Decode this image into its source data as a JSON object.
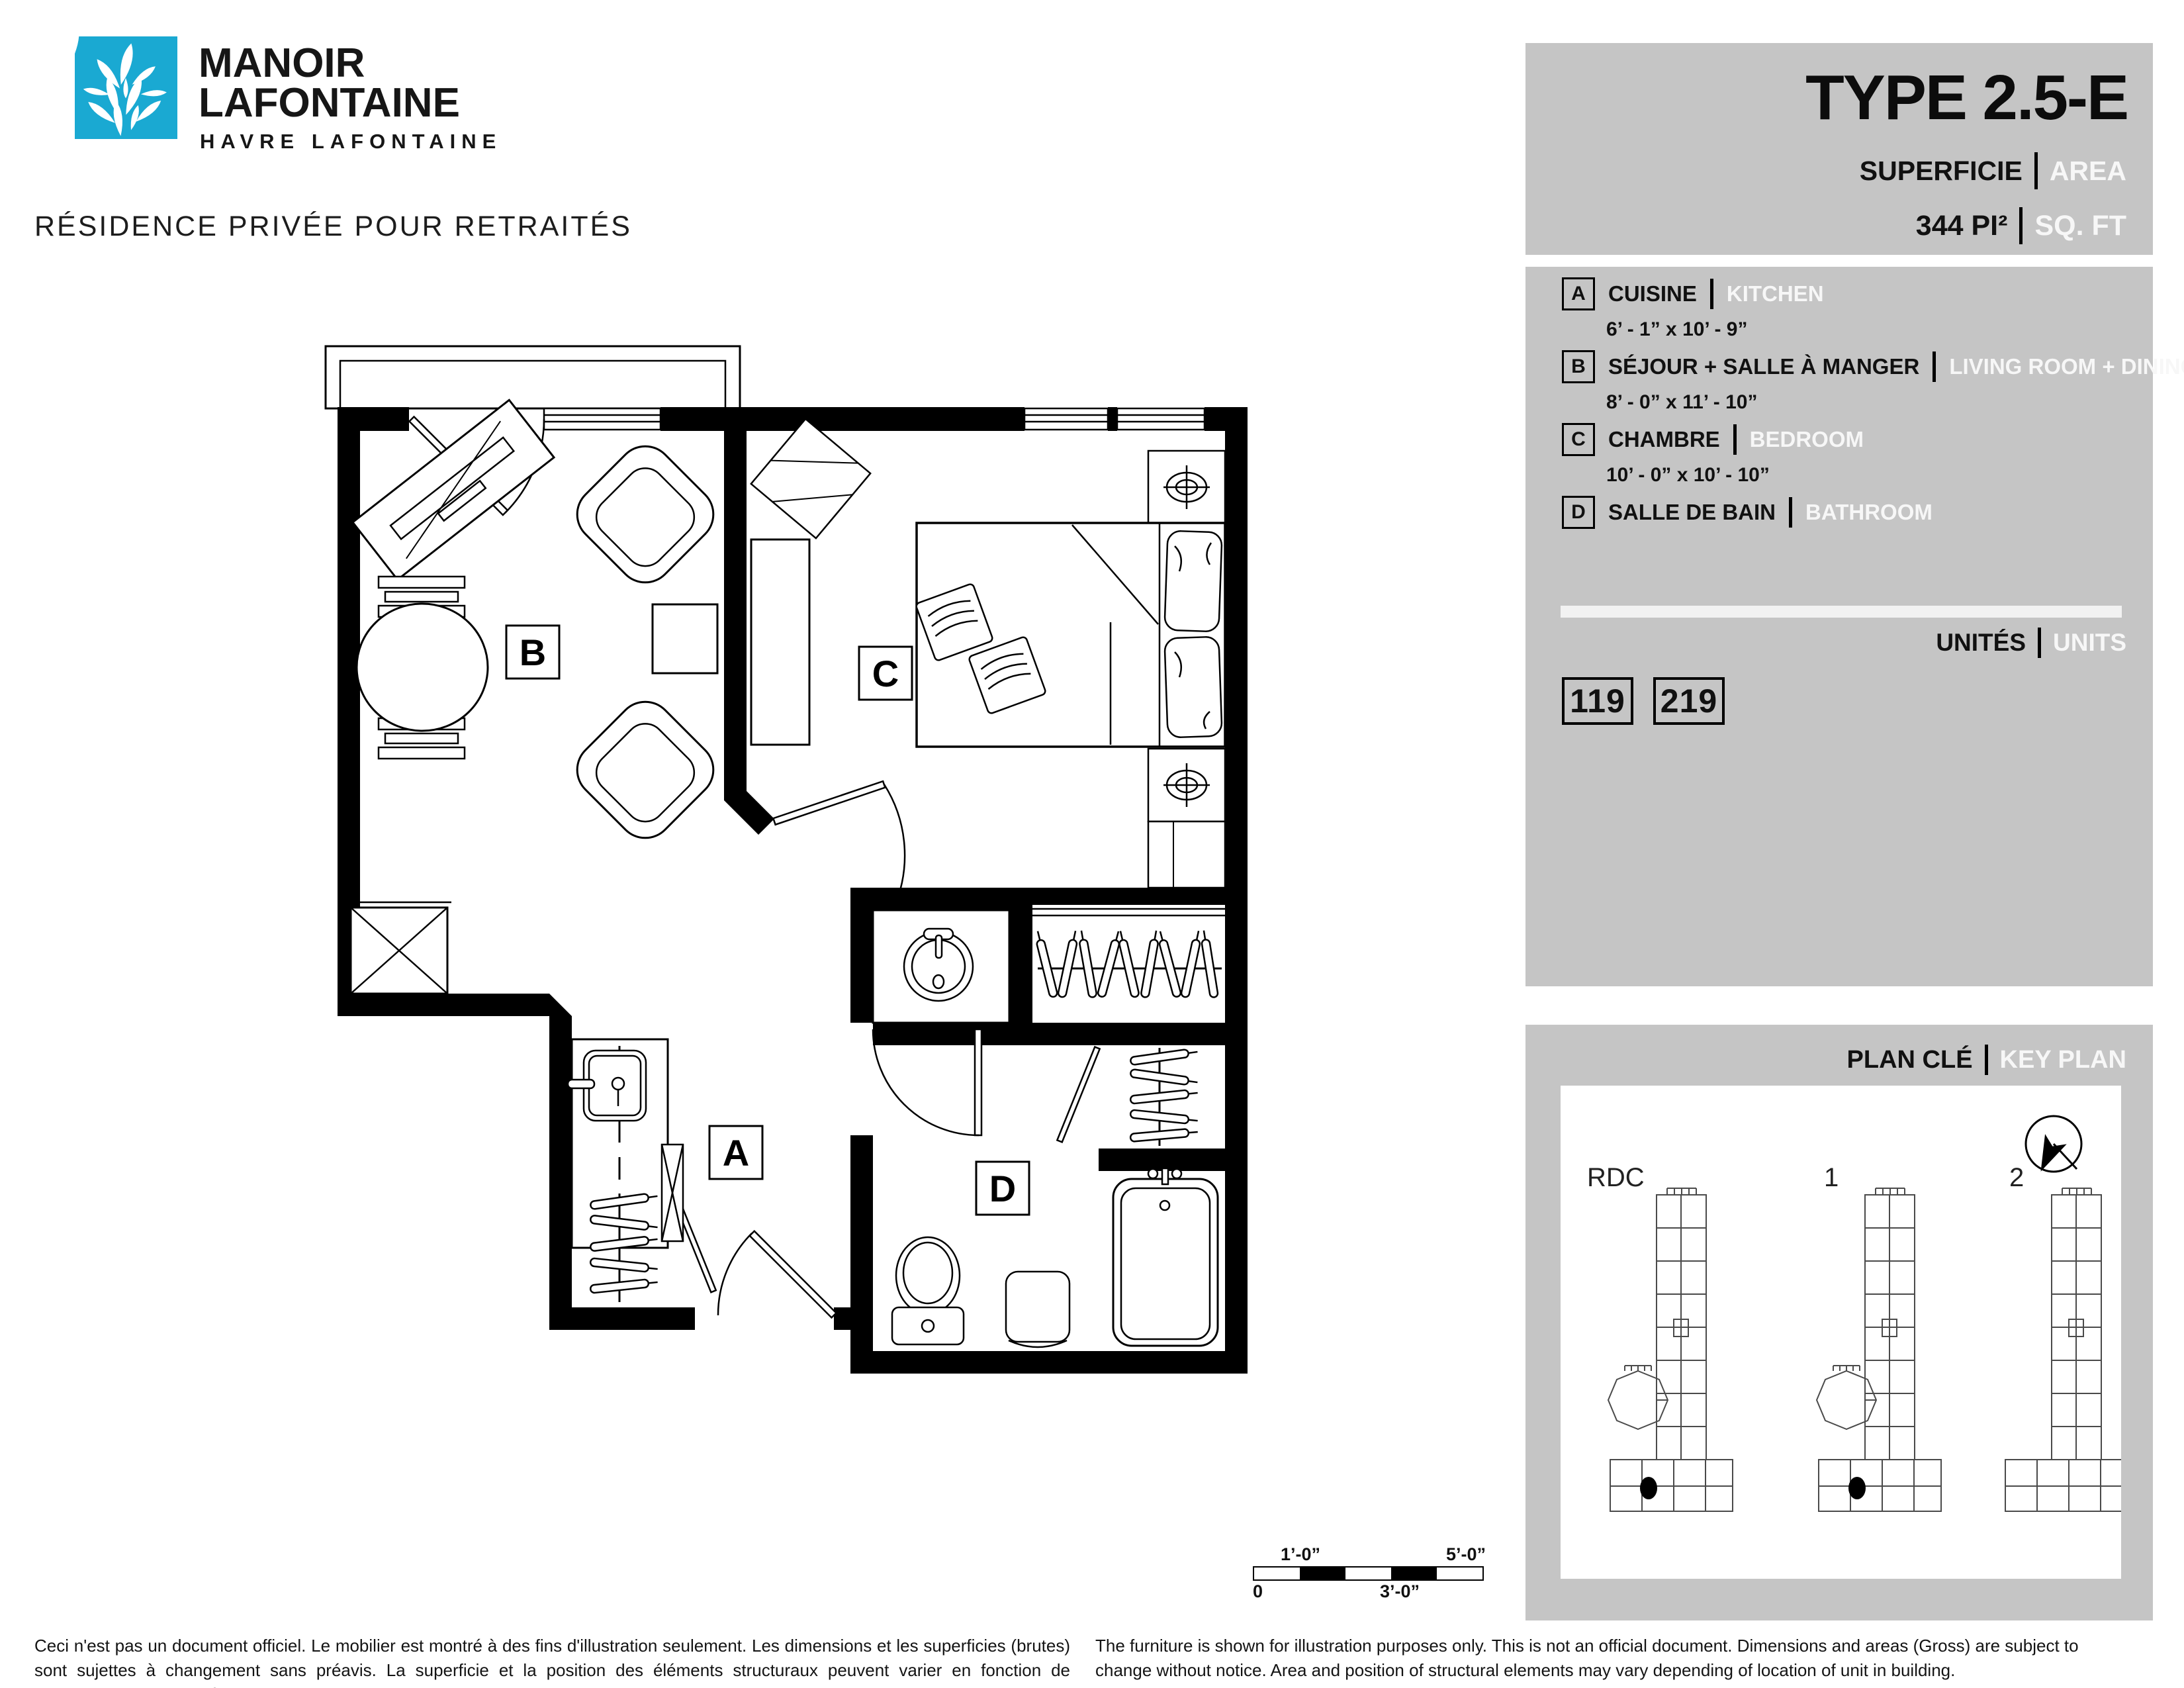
{
  "brand": {
    "logo_color": "#1aa9d2",
    "logo_icon": "leaf-cluster",
    "name_line1": "MANOIR",
    "name_line2": "LAFONTAINE",
    "subtitle": "HAVRE LAFONTAINE",
    "tagline": "RÉSIDENCE PRIVÉE POUR RETRAITÉS"
  },
  "title_panel": {
    "type_label": "TYPE 2.5-E",
    "superficie_fr": "SUPERFICIE",
    "superficie_en": "AREA",
    "area_value": "344  PI²",
    "area_unit_en": "SQ. FT"
  },
  "legend": {
    "items": [
      {
        "key": "A",
        "name_fr": "CUISINE",
        "name_en": "KITCHEN",
        "dimensions": "6’ - 1” x 10’ - 9”"
      },
      {
        "key": "B",
        "name_fr": "SÉJOUR + SALLE À MANGER",
        "name_en": "LIVING ROOM + DINING",
        "dimensions": "8’ - 0” x 11’ - 10”"
      },
      {
        "key": "C",
        "name_fr": "CHAMBRE",
        "name_en": "BEDROOM",
        "dimensions": "10’ -  0” x 10’ - 10”"
      },
      {
        "key": "D",
        "name_fr": "SALLE DE BAIN",
        "name_en": "BATHROOM",
        "dimensions": ""
      }
    ]
  },
  "units": {
    "label_fr": "UNITÉS",
    "label_en": "UNITS",
    "numbers": [
      "119",
      "219"
    ]
  },
  "key_plan": {
    "label_fr": "PLAN CLÉ",
    "label_en": "KEY PLAN",
    "compass_icon": "north-arrow-compass",
    "floors": [
      "RDC",
      "1",
      "2"
    ]
  },
  "floor_plan": {
    "room_labels": {
      "a": "A",
      "b": "B",
      "c": "C",
      "d": "D"
    }
  },
  "scale_bar": {
    "tick_top_left": "1’-0”",
    "tick_top_right": "5’-0”",
    "tick_bottom_left": "0",
    "tick_bottom_mid": "3’-0”"
  },
  "disclaimer_fr": "Ceci n'est pas un document officiel. Le mobilier est montré à des fins d'illustration seulement. Les dimensions et les superficies (brutes) sont sujettes à changement sans préavis. La superficie et la position des éléments structuraux peuvent varier en fonction de l'emplacement de l'unité dans le bâtiment.",
  "disclaimer_en": "The furniture is shown for illustration purposes only. This is not an official document. Dimensions and areas (Gross) are subject to change without notice. Area and position of structural elements may vary depending of location of unit in building."
}
